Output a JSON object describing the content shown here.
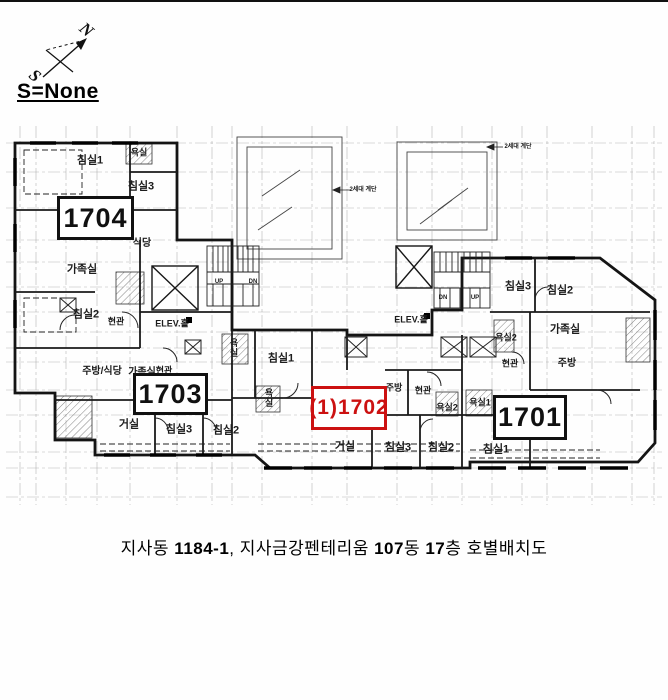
{
  "window": {
    "background": "#fefefe"
  },
  "compass": {
    "north_label": "N",
    "south_label": "S",
    "scale_label": "S=None"
  },
  "plan": {
    "unit_boxes": [
      {
        "name": "1704",
        "label": "1704",
        "x": 57,
        "y": 196,
        "w": 77,
        "h": 44,
        "color": "#111111",
        "font": 27
      },
      {
        "name": "1703",
        "label": "1703",
        "x": 133,
        "y": 373,
        "w": 75,
        "h": 42,
        "color": "#111111",
        "font": 27
      },
      {
        "name": "1702",
        "label": "(1)1702",
        "x": 311,
        "y": 386,
        "w": 76,
        "h": 44,
        "color": "#cc1111",
        "font": 21
      },
      {
        "name": "1701",
        "label": "1701",
        "x": 493,
        "y": 395,
        "w": 74,
        "h": 45,
        "color": "#111111",
        "font": 27
      }
    ],
    "room_labels": [
      {
        "unit": "1704",
        "text": "침실1",
        "x": 90,
        "y": 161,
        "size": 11
      },
      {
        "unit": "1704",
        "text": "욕실",
        "x": 139,
        "y": 153,
        "size": 9
      },
      {
        "unit": "1704",
        "text": "침실3",
        "x": 141,
        "y": 187,
        "size": 11
      },
      {
        "unit": "1704",
        "text": "식당",
        "x": 142,
        "y": 244,
        "size": 10
      },
      {
        "unit": "1704",
        "text": "가족실",
        "x": 82,
        "y": 270,
        "size": 11
      },
      {
        "unit": "1704",
        "text": "침실2",
        "x": 86,
        "y": 315,
        "size": 11
      },
      {
        "unit": "1704",
        "text": "현관",
        "x": 116,
        "y": 322,
        "size": 9
      },
      {
        "unit": "1703",
        "text": "주방/식당",
        "x": 102,
        "y": 372,
        "size": 10
      },
      {
        "unit": "1703",
        "text": "가족실",
        "x": 142,
        "y": 373,
        "size": 10
      },
      {
        "unit": "1703",
        "text": "현관",
        "x": 164,
        "y": 371,
        "size": 9
      },
      {
        "unit": "1703",
        "text": "거실",
        "x": 129,
        "y": 425,
        "size": 11
      },
      {
        "unit": "1703",
        "text": "침실3",
        "x": 179,
        "y": 430,
        "size": 11
      },
      {
        "unit": "1703",
        "text": "침실2",
        "x": 226,
        "y": 431,
        "size": 11
      },
      {
        "unit": "1702",
        "text": "욕실",
        "x": 233,
        "y": 348,
        "size": 9,
        "vertical": true
      },
      {
        "unit": "1702",
        "text": "침실1",
        "x": 281,
        "y": 359,
        "size": 11
      },
      {
        "unit": "1702",
        "text": "욕실",
        "x": 268,
        "y": 398,
        "size": 9,
        "vertical": true
      },
      {
        "unit": "1702",
        "text": "주방",
        "x": 394,
        "y": 388,
        "size": 9
      },
      {
        "unit": "1702",
        "text": "현관",
        "x": 423,
        "y": 391,
        "size": 9
      },
      {
        "unit": "1702",
        "text": "욕실2",
        "x": 447,
        "y": 408,
        "size": 9
      },
      {
        "unit": "1702",
        "text": "거실",
        "x": 345,
        "y": 447,
        "size": 11
      },
      {
        "unit": "1702",
        "text": "침실3",
        "x": 398,
        "y": 448,
        "size": 11
      },
      {
        "unit": "1702",
        "text": "침실2",
        "x": 441,
        "y": 448,
        "size": 11
      },
      {
        "unit": "1701",
        "text": "침실3",
        "x": 518,
        "y": 287,
        "size": 11
      },
      {
        "unit": "1701",
        "text": "침실2",
        "x": 560,
        "y": 291,
        "size": 11
      },
      {
        "unit": "1701",
        "text": "가족실",
        "x": 565,
        "y": 330,
        "size": 11
      },
      {
        "unit": "1701",
        "text": "욕실2",
        "x": 506,
        "y": 338,
        "size": 9
      },
      {
        "unit": "1701",
        "text": "현관",
        "x": 510,
        "y": 364,
        "size": 9
      },
      {
        "unit": "1701",
        "text": "주방",
        "x": 567,
        "y": 364,
        "size": 10
      },
      {
        "unit": "1701",
        "text": "욕실1",
        "x": 480,
        "y": 403,
        "size": 9
      },
      {
        "unit": "1701",
        "text": "침실1",
        "x": 496,
        "y": 450,
        "size": 11
      },
      {
        "unit": "core",
        "text": "ELEV.홀",
        "x": 172,
        "y": 324,
        "size": 9
      },
      {
        "unit": "core",
        "text": "ELEV.홀",
        "x": 411,
        "y": 320,
        "size": 9
      },
      {
        "unit": "core",
        "text": "UP",
        "x": 219,
        "y": 282,
        "size": 6
      },
      {
        "unit": "core",
        "text": "DN",
        "x": 253,
        "y": 282,
        "size": 6
      },
      {
        "unit": "core",
        "text": "DN",
        "x": 443,
        "y": 298,
        "size": 6
      },
      {
        "unit": "core",
        "text": "UP",
        "x": 475,
        "y": 298,
        "size": 6
      },
      {
        "unit": "core",
        "text": "2세대 계단",
        "x": 363,
        "y": 190,
        "size": 6
      },
      {
        "unit": "core",
        "text": "2세대 계단",
        "x": 518,
        "y": 147,
        "size": 6
      }
    ]
  },
  "caption": {
    "parts": [
      {
        "t": "지사동 ",
        "b": 0
      },
      {
        "t": "1184-1",
        "b": 1
      },
      {
        "t": ", 지사금강펜테리움 ",
        "b": 0
      },
      {
        "t": "107",
        "b": 1
      },
      {
        "t": "동 ",
        "b": 0
      },
      {
        "t": "17",
        "b": 1
      },
      {
        "t": "층 호별배치도",
        "b": 0
      }
    ]
  }
}
